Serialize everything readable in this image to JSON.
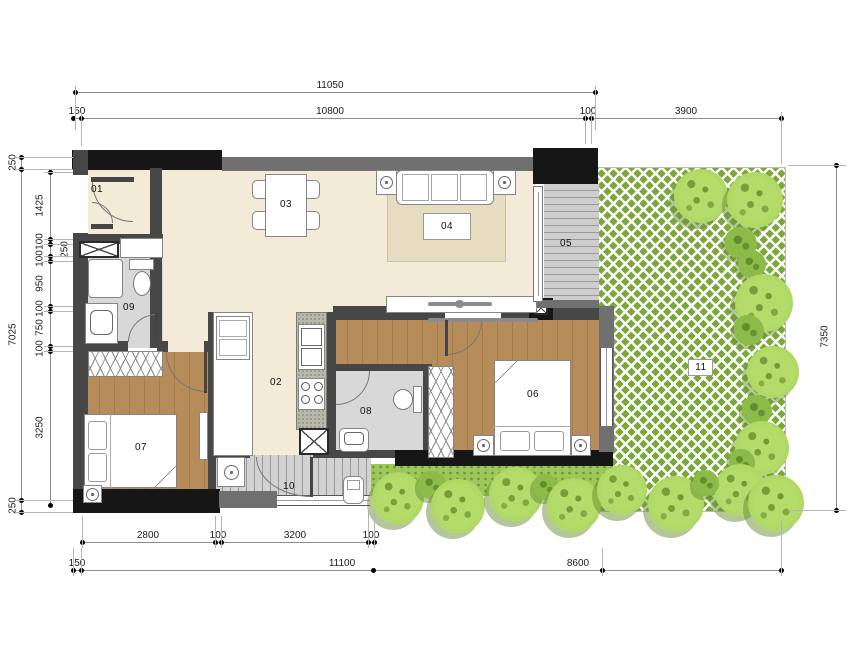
{
  "title": "apartment-floor-plan",
  "dims": {
    "top": [
      "11050",
      "150",
      "10800",
      "100",
      "3900"
    ],
    "bottom_inner": [
      "2800",
      "100",
      "3200",
      "100"
    ],
    "bottom_outer": [
      "150",
      "11100",
      "8600"
    ],
    "left_outer": [
      "250",
      "7025",
      "250"
    ],
    "left_inner": [
      "1425",
      "100",
      "250",
      "100",
      "950",
      "100",
      "750",
      "100",
      "3250"
    ],
    "right": [
      "7350"
    ]
  },
  "rooms": [
    "01",
    "02",
    "03",
    "04",
    "05",
    "06",
    "07",
    "08",
    "09",
    "10",
    "11"
  ],
  "colors": {
    "wall_dark": "#161616",
    "wall_gray": "#707070",
    "wall_mid": "#474747",
    "floor_beige": "#f3ead7",
    "wood": "#b68c5a",
    "tile": "#d8d8d8",
    "deck": "#cccccc",
    "lattice_green": "#7aa93a",
    "tree_green": "#abd45f",
    "rug": "#e6dcc0"
  }
}
